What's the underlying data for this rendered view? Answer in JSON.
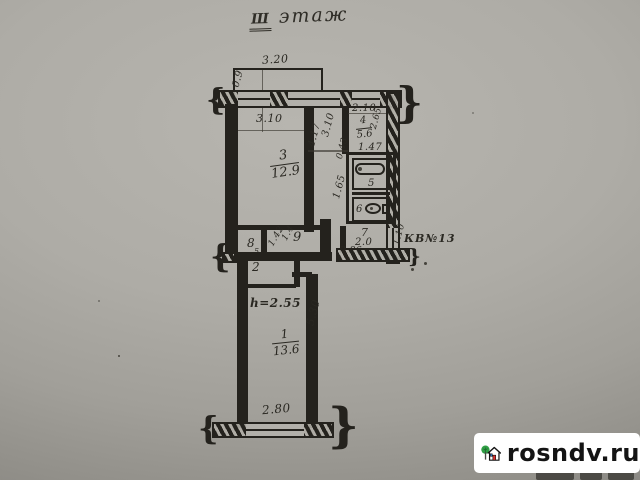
{
  "title": {
    "numeral": "Ш",
    "word": "этаж"
  },
  "apartment_label": "КВ№13",
  "height_note": "h=2.55",
  "rooms": {
    "room1": {
      "number": "1",
      "area": "13.6"
    },
    "room2": {
      "number": "2"
    },
    "room3": {
      "number": "3",
      "area": "12.9"
    },
    "room4": {
      "number": "4",
      "area": "5.6"
    },
    "room5": {
      "number": "5"
    },
    "room6": {
      "number": "6"
    },
    "room7": {
      "number": "7",
      "area": "2.0"
    },
    "room8": {
      "number": "8",
      "mark": "5"
    },
    "room9": {
      "number": "9"
    }
  },
  "dims": {
    "balcony_top": "3.20",
    "balcony_top_depth": "0.9",
    "room3_width": "3.10",
    "room3_length": "4.17",
    "hall_length": "3.10",
    "room4_width": "2.10",
    "room4_depth": "2.65",
    "bath_width": "1.47",
    "bath_small": "0.43",
    "bath_depth": "1.65",
    "hall9_a": "1.42",
    "hall9_b": "1.4",
    "entry_width": "2.86",
    "entry_depth": "1.10",
    "room1_length": "5.30",
    "balcony_bottom": "2.80"
  },
  "watermark": {
    "site": "rosndv.ru"
  },
  "colors": {
    "ink": "#24221d",
    "paper": "#b2b0aa",
    "logo_green": "#2f9e44",
    "logo_red": "#e0312f"
  }
}
